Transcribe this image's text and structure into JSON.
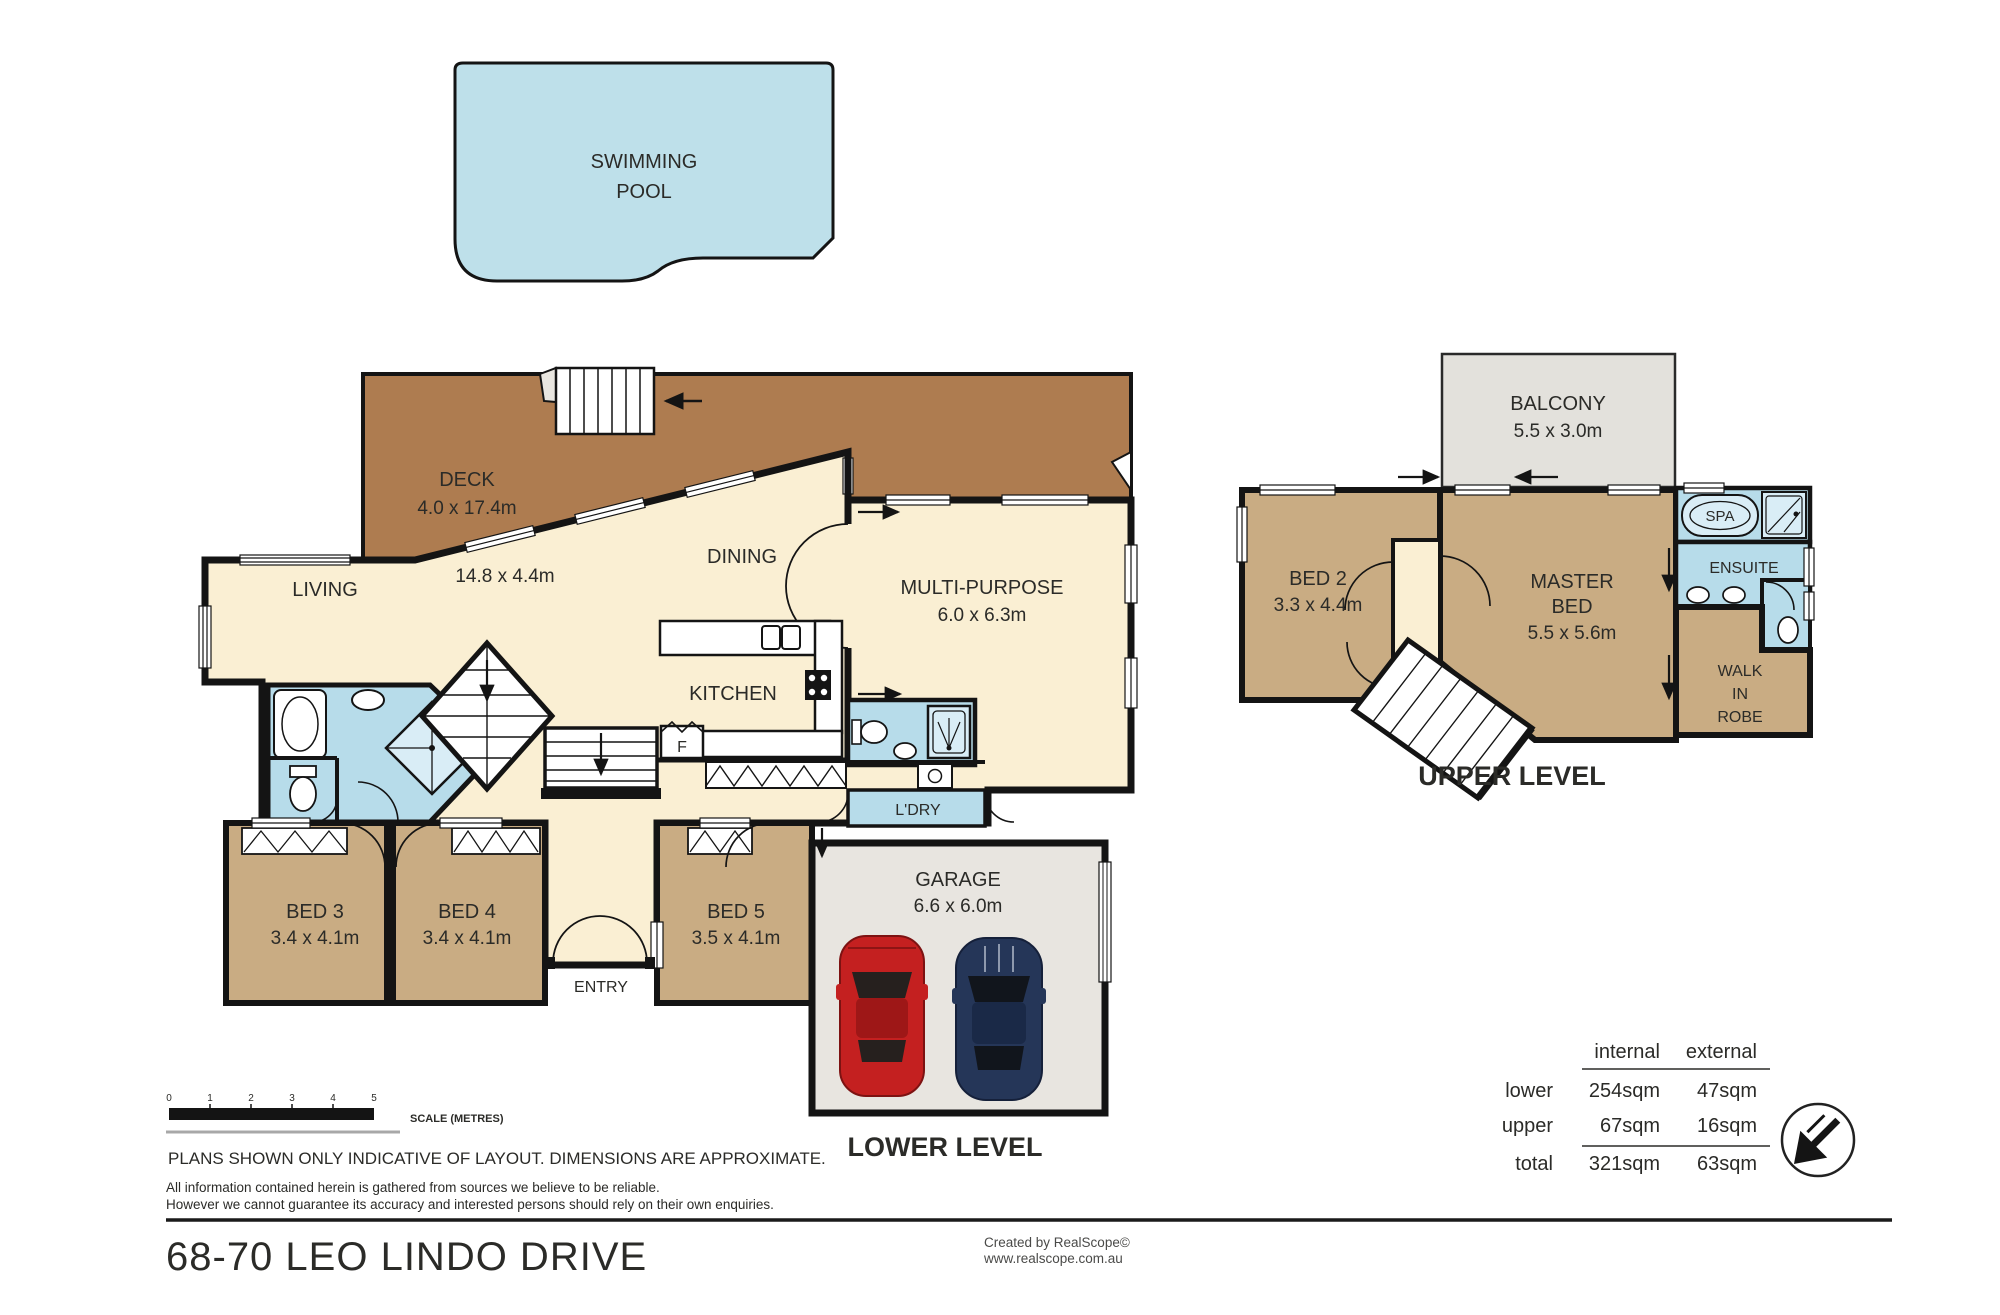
{
  "address": "68-70 LEO LINDO DRIVE",
  "levels": {
    "lower": "LOWER LEVEL",
    "upper": "UPPER LEVEL"
  },
  "pool": {
    "line1": "SWIMMING",
    "line2": "POOL"
  },
  "rooms": {
    "deck": {
      "name": "DECK",
      "dims": "4.0 x 17.4m"
    },
    "living": {
      "name": "LIVING",
      "dims": "14.8 x 4.4m"
    },
    "dining": {
      "name": "DINING"
    },
    "kitchen": {
      "name": "KITCHEN"
    },
    "multi": {
      "name": "MULTI-PURPOSE",
      "dims": "6.0 x 6.3m"
    },
    "bed3": {
      "name": "BED 3",
      "dims": "3.4 x 4.1m"
    },
    "bed4": {
      "name": "BED 4",
      "dims": "3.4 x 4.1m"
    },
    "bed5": {
      "name": "BED 5",
      "dims": "3.5 x 4.1m"
    },
    "entry": {
      "name": "ENTRY"
    },
    "laundry": {
      "name": "L'DRY"
    },
    "fridge": {
      "name": "F"
    },
    "garage": {
      "name": "GARAGE",
      "dims": "6.6 x 6.0m"
    },
    "balcony": {
      "name": "BALCONY",
      "dims": "5.5 x 3.0m"
    },
    "bed2": {
      "name": "BED 2",
      "dims": "3.3 x 4.4m"
    },
    "master": {
      "line1": "MASTER",
      "line2": "BED",
      "dims": "5.5 x 5.6m"
    },
    "spa": {
      "name": "SPA"
    },
    "ensuite": {
      "name": "ENSUITE"
    },
    "robe": {
      "line1": "WALK",
      "line2": "IN",
      "line3": "ROBE"
    }
  },
  "scale_bar": {
    "ticks": [
      "0",
      "1",
      "2",
      "3",
      "4",
      "5"
    ],
    "caption": "SCALE (METRES)"
  },
  "disclaimer": {
    "line1": "PLANS SHOWN ONLY INDICATIVE OF LAYOUT.  DIMENSIONS ARE APPROXIMATE.",
    "line2": "All information contained herein is gathered from sources we believe to be reliable.",
    "line3": "However we cannot guarantee its accuracy and interested persons should rely on their own enquiries."
  },
  "credits": {
    "line1": "Created by RealScope©",
    "line2": "www.realscope.com.au"
  },
  "area_table": {
    "col_headers": [
      "internal",
      "external"
    ],
    "rows": [
      {
        "label": "lower",
        "internal": "254sqm",
        "external": "47sqm"
      },
      {
        "label": "upper",
        "internal": "67sqm",
        "external": "16sqm"
      },
      {
        "label": "total",
        "internal": "321sqm",
        "external": "63sqm"
      }
    ]
  },
  "colors": {
    "floor": "#FAEFD3",
    "deck": "#AE7C50",
    "bedroom": "#C9AC83",
    "wet": "#B7DCEA",
    "pool": "#BEE0EA",
    "garage": "#E8E5E0",
    "balcony": "#E3E1DC",
    "shower": "#D9EDF6",
    "wall": "#141414"
  }
}
